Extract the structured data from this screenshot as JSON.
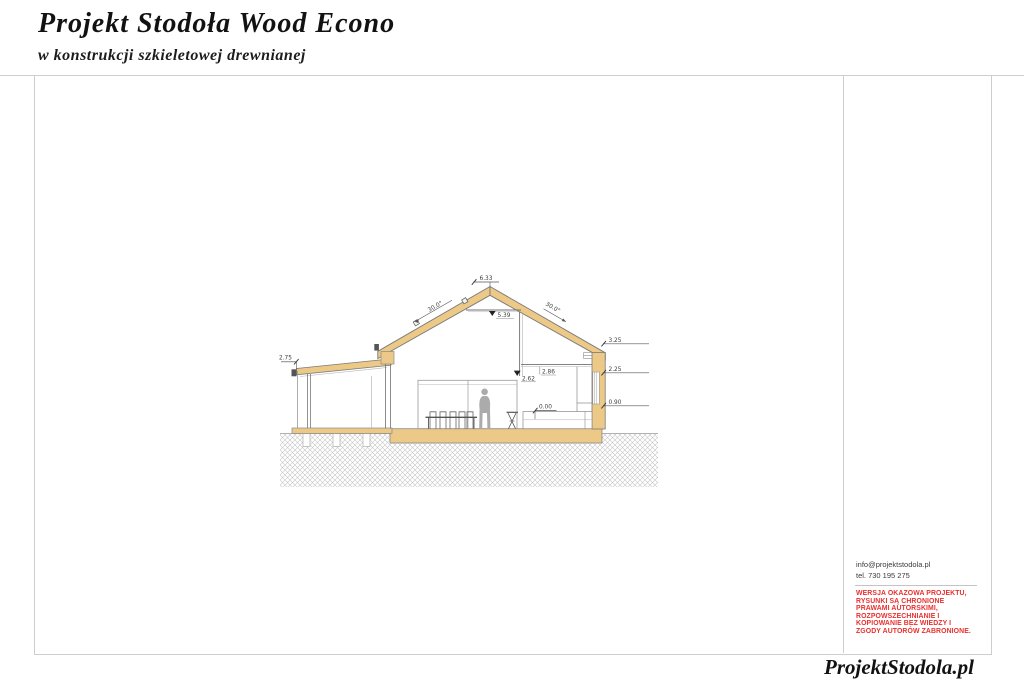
{
  "header": {
    "title": "Projekt Stodoła Wood Econo",
    "subtitle": "w konstrukcji szkieletowej drewnianej"
  },
  "sidebar": {
    "email": "info@projektstodola.pl",
    "phone": "tel. 730 195 275",
    "warning_color": "#e8302e",
    "warning_lines": [
      "WERSJA OKAZOWA PROJEKTU,",
      "RYSUNKI  SĄ CHRONIONE",
      "PRAWAMI AUTORSKIMI,",
      "ROZPOWSZECHNIANIE I",
      "KOPIOWANIE BEZ WIEDZY I",
      "ZGODY AUTORÓW ZABRONIONE."
    ]
  },
  "footer": {
    "logo": "ProjektStodola.pl"
  },
  "drawing": {
    "type": "architectural-cross-section",
    "levels": {
      "ridge": "6.33",
      "collar": "5.39",
      "attic": "2.86",
      "opening": "2.62",
      "eave": "3.25",
      "window_head": "2.25",
      "window_sill": "0.90",
      "floor": "0.00",
      "porch": "2.75"
    },
    "angles": {
      "left": "30.0°",
      "right": "30.0°"
    },
    "colors": {
      "wood": "#ecc986",
      "person": "#ababab",
      "hatch": "#c6c6c6"
    }
  }
}
